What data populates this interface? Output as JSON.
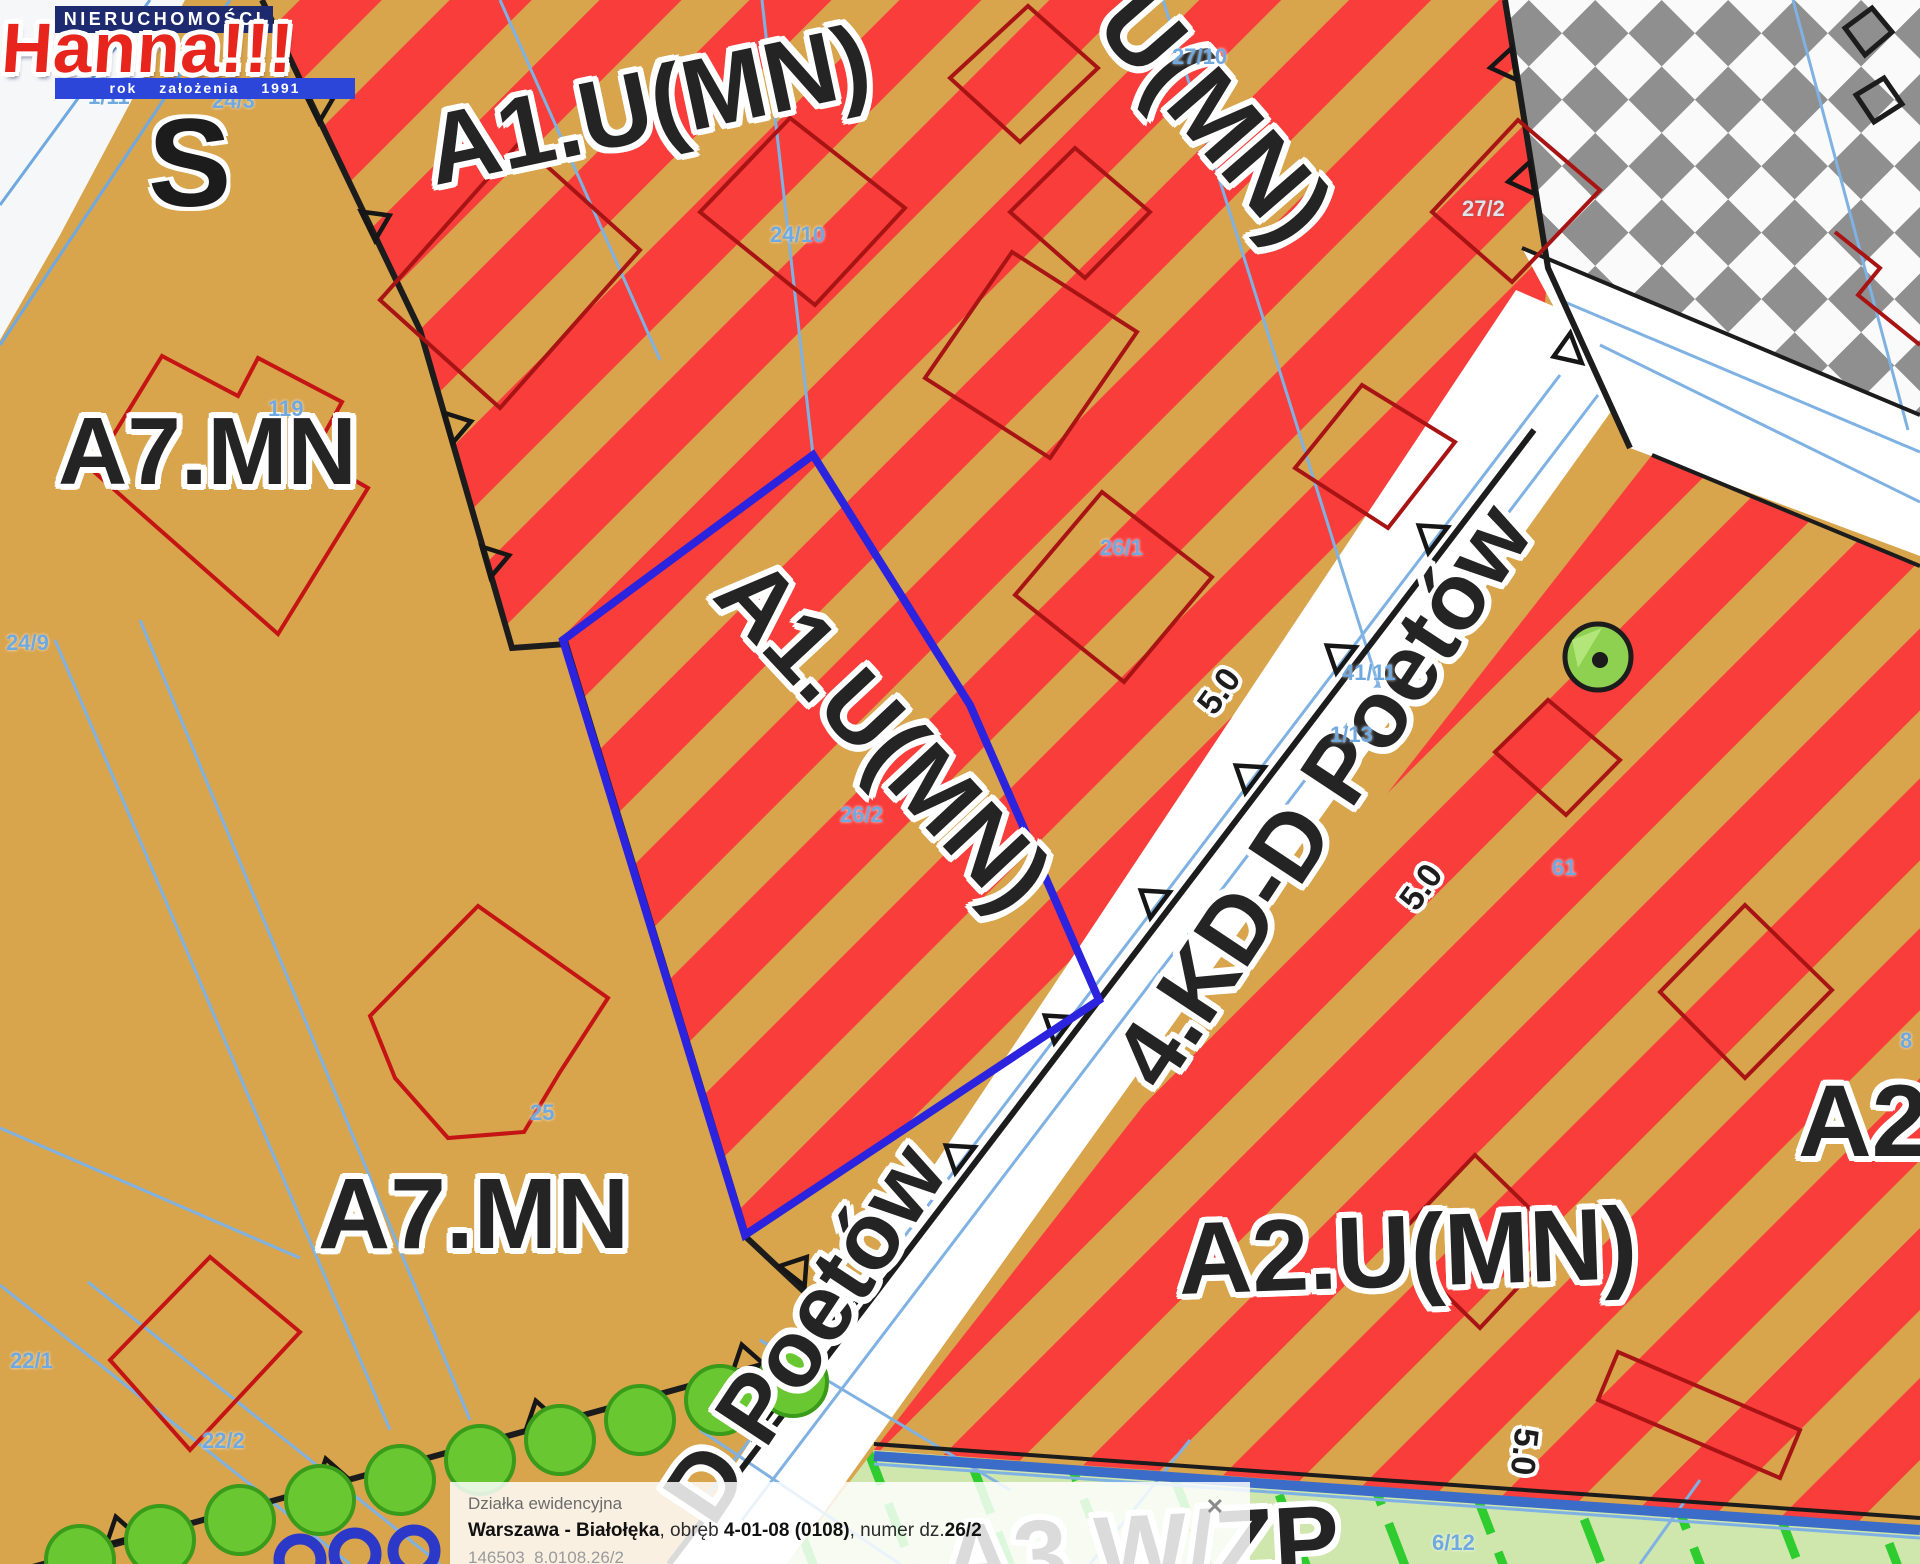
{
  "logo": {
    "line1": "NIERUCHOMOŚCI",
    "name": "Hanna!!!",
    "tagline": "rok założenia 1991"
  },
  "zones": {
    "a1_top": "A1.U(MN)",
    "u_mn_topright": "U(MN)",
    "a7_upper": "A7.MN",
    "a1_selected": "A1.U(MN)",
    "a7_lower": "A7.MN",
    "a2_bottom": "A2.U(MN)",
    "a2_right": "A2",
    "a3_bottom": "A3.W/ZP"
  },
  "roads": {
    "main": "4.KD-D Poetów",
    "partial": "D Poetów"
  },
  "dims": {
    "d1": "5.0",
    "d2": "5.0",
    "d3": "5.0"
  },
  "parcels": {
    "p1": "1/11",
    "p2": "24/3",
    "p3": "24/10",
    "p4": "27/10",
    "p5": "27/2",
    "p6": "119",
    "p7": "24/9",
    "p8": "26/1",
    "p9": "26/2",
    "p10": "41/11",
    "p11": "1/13",
    "p12": "25",
    "p13": "22/1",
    "p14": "22/2",
    "p15": "61",
    "p16": "6/12",
    "p17": "8"
  },
  "map_fragment_glyph": "S",
  "popup": {
    "title": "Działka ewidencyjna",
    "city_bold": "Warszawa - Białołęka",
    "mid1": ", obręb ",
    "obreb_bold": "4-01-08 (0108)",
    "mid2": ", numer dz.",
    "nr_bold": "26/2",
    "meta": "146503  8.0108.26/2",
    "close": "✕"
  },
  "colors": {
    "stripe_red": "#f83d3b",
    "tan_zone": "#d8a44c",
    "checker_gray": "#8f8f8f",
    "road_white": "#ffffff",
    "green_zone": "#cfe7ad",
    "hatch_green": "#2ecc2e",
    "tree_green": "#69c832",
    "selection_blue": "#2b23dd",
    "boundary_black": "#1c1c1c",
    "building_red": "#a81414",
    "parcel_text_blue": "#6fa9e0",
    "logo_red": "#e8251c",
    "logo_navy": "#1d2a70",
    "logo_blue": "#2b46d8"
  }
}
